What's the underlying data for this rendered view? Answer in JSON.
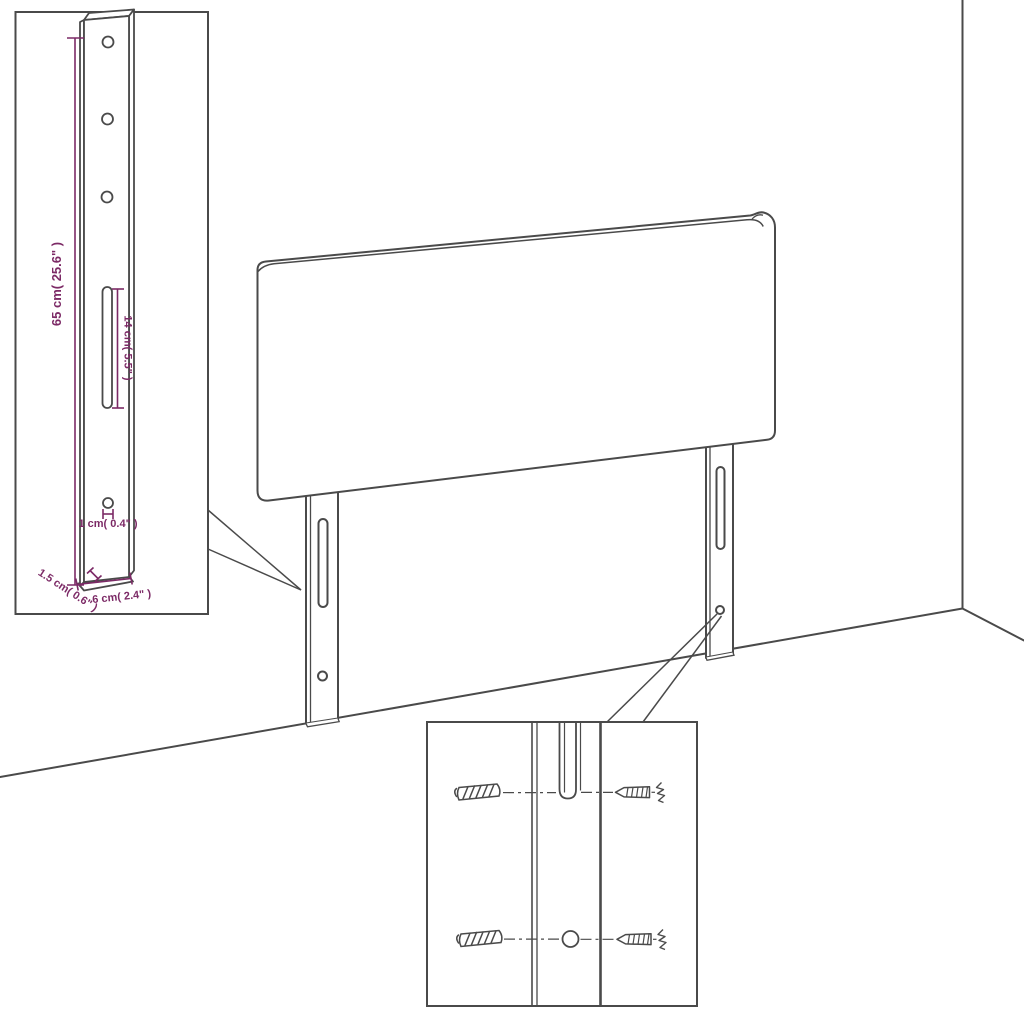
{
  "diagram": {
    "kind": "headboard-assembly-dimension-diagram",
    "colors": {
      "line": "#4a4a4a",
      "dimension": "#7c2a66",
      "background": "#ffffff"
    },
    "leg_detail_inset": {
      "dim_height": "65 cm( 25.6\" )",
      "dim_slot_length": "14 cm( 5.5\" )",
      "dim_hole": "1 cm( 0.4\" )",
      "dim_thickness": "1.5 cm( 0.6\" )",
      "dim_width": "6 cm( 2.4\" )"
    }
  }
}
